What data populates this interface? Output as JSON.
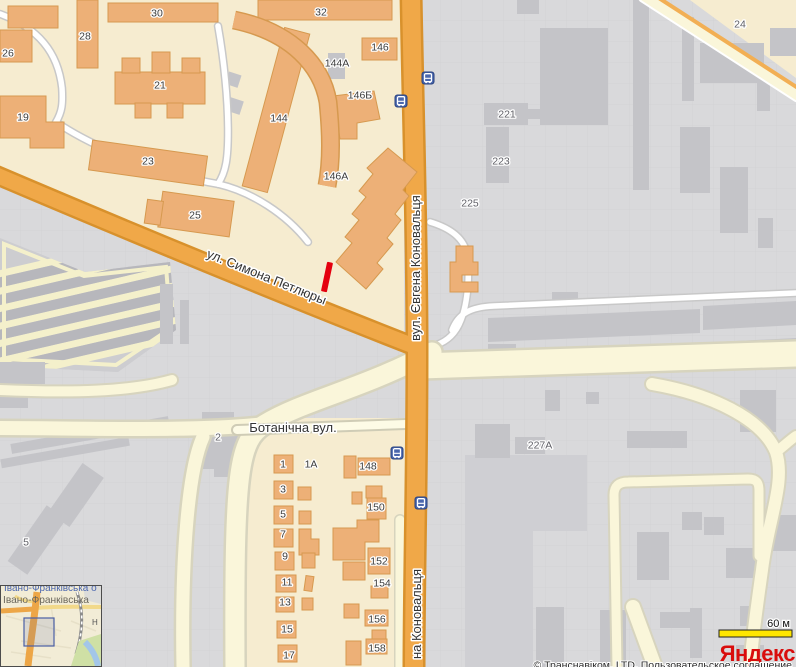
{
  "map": {
    "street_labels": [
      {
        "text": "ул. Симона Петлюры",
        "x": 265,
        "y": 281,
        "rotate": 22
      },
      {
        "text": "вул. Євгена Коновальця",
        "x": 420,
        "y": 268,
        "rotate": -90
      },
      {
        "text": "на Коновальця",
        "x": 421,
        "y": 614,
        "rotate": -90
      },
      {
        "text": "Ботанічна вул.",
        "x": 293,
        "y": 432,
        "rotate": 0
      }
    ],
    "building_labels": [
      {
        "text": "30",
        "x": 157,
        "y": 13,
        "tone": "dark"
      },
      {
        "text": "32",
        "x": 321,
        "y": 12,
        "tone": "dark"
      },
      {
        "text": "28",
        "x": 85,
        "y": 36,
        "tone": "dark"
      },
      {
        "text": "26",
        "x": 8,
        "y": 53,
        "tone": "dark"
      },
      {
        "text": "146",
        "x": 380,
        "y": 47,
        "tone": "dark"
      },
      {
        "text": "144А",
        "x": 337,
        "y": 63,
        "tone": "dark"
      },
      {
        "text": "21",
        "x": 160,
        "y": 85,
        "tone": "dark"
      },
      {
        "text": "146Б",
        "x": 360,
        "y": 95,
        "tone": "dark"
      },
      {
        "text": "19",
        "x": 23,
        "y": 117,
        "tone": "dark"
      },
      {
        "text": "144",
        "x": 279,
        "y": 118,
        "tone": "dark"
      },
      {
        "text": "23",
        "x": 148,
        "y": 161,
        "tone": "dark"
      },
      {
        "text": "146А",
        "x": 336,
        "y": 176,
        "tone": "dark"
      },
      {
        "text": "25",
        "x": 195,
        "y": 215,
        "tone": "dark"
      },
      {
        "text": "221",
        "x": 507,
        "y": 114,
        "tone": "gray"
      },
      {
        "text": "223",
        "x": 501,
        "y": 161,
        "tone": "gray"
      },
      {
        "text": "225",
        "x": 470,
        "y": 203,
        "tone": "gray"
      },
      {
        "text": "24",
        "x": 740,
        "y": 24,
        "tone": "gray"
      },
      {
        "text": "2",
        "x": 218,
        "y": 437,
        "tone": "gray"
      },
      {
        "text": "227А",
        "x": 540,
        "y": 445,
        "tone": "gray"
      },
      {
        "text": "5",
        "x": 26,
        "y": 542,
        "tone": "gray"
      },
      {
        "text": "1",
        "x": 283,
        "y": 464,
        "tone": "dark"
      },
      {
        "text": "1А",
        "x": 311,
        "y": 464,
        "tone": "dark"
      },
      {
        "text": "148",
        "x": 368,
        "y": 466,
        "tone": "dark"
      },
      {
        "text": "3",
        "x": 283,
        "y": 489,
        "tone": "dark"
      },
      {
        "text": "150",
        "x": 376,
        "y": 507,
        "tone": "dark"
      },
      {
        "text": "5",
        "x": 283,
        "y": 514,
        "tone": "dark"
      },
      {
        "text": "7",
        "x": 283,
        "y": 534,
        "tone": "dark"
      },
      {
        "text": "9",
        "x": 285,
        "y": 556,
        "tone": "dark"
      },
      {
        "text": "152",
        "x": 379,
        "y": 561,
        "tone": "dark"
      },
      {
        "text": "11",
        "x": 287,
        "y": 582,
        "tone": "dark"
      },
      {
        "text": "154",
        "x": 382,
        "y": 583,
        "tone": "dark"
      },
      {
        "text": "13",
        "x": 285,
        "y": 602,
        "tone": "dark"
      },
      {
        "text": "156",
        "x": 377,
        "y": 619,
        "tone": "dark"
      },
      {
        "text": "15",
        "x": 287,
        "y": 629,
        "tone": "dark"
      },
      {
        "text": "158",
        "x": 377,
        "y": 648,
        "tone": "dark"
      },
      {
        "text": "17",
        "x": 289,
        "y": 655,
        "tone": "dark"
      }
    ],
    "bus_stops": [
      {
        "x": 428,
        "y": 78
      },
      {
        "x": 401,
        "y": 101
      },
      {
        "x": 397,
        "y": 453
      },
      {
        "x": 421,
        "y": 503
      }
    ],
    "marker": {
      "x": 327,
      "y": 277,
      "rotate": 12,
      "length": 30,
      "width": 6
    },
    "scale_label": "60 м",
    "logo_text": "Яндекс",
    "copyright": "© Транснавіком, LTD, Пользовательское соглашение",
    "inset": {
      "title": "Івано-Франківська",
      "title_cut": "Івано-Франківська о",
      "station_letter": "Н"
    }
  },
  "colors": {
    "road_main": "#f0a848",
    "road_casing": "#d8912c",
    "residential": "#f6ecd0",
    "building_orange": "#edb077",
    "building_gray": "#c4c4c8",
    "industrial_bg": "#d9d9db",
    "marker": "#e4000f",
    "bus": "#4a67ad",
    "scale_bar": "#ffe600",
    "logo": "#d90d0d"
  }
}
